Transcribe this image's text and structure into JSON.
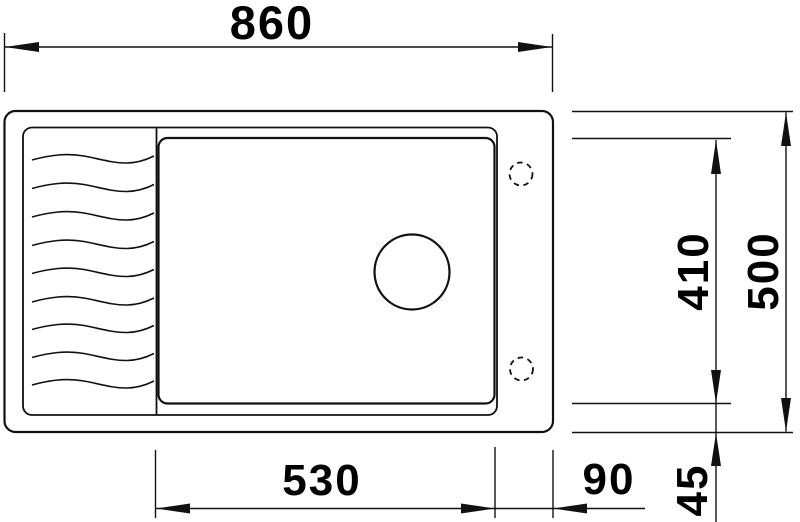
{
  "diagram": {
    "title": "Sink dimension drawing, top view",
    "units": "mm",
    "colors": {
      "line": "#111111",
      "text": "#000000",
      "background": "#ffffff"
    },
    "dimensions": {
      "overall_width": "860",
      "overall_depth": "500",
      "bowl_depth": "410",
      "bowl_width": "530",
      "right_ledge_width": "90",
      "bottom_ledge_depth": "45"
    },
    "features": {
      "drainboard_ripple_lines": 9,
      "tap_holes_dashed": 2,
      "drain_holes": 1
    }
  }
}
